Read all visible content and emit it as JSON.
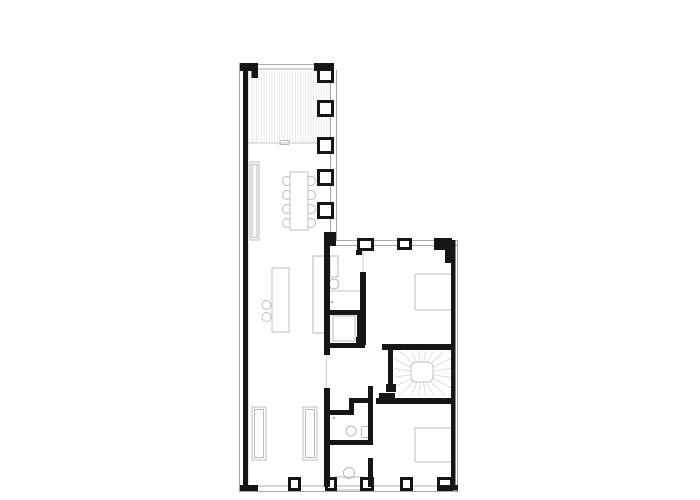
{
  "document": {
    "kind": "architectural-floor-plan",
    "background": "#ffffff",
    "canvas": {
      "width": 700,
      "height": 500
    }
  },
  "palette": {
    "wall_black": "#161616",
    "outer_face_gray": "#8f8f8f",
    "sill_gray": "#c4c4c4",
    "furniture_gray": "#bdbdbd",
    "hatch_gray": "#e1e1e1",
    "tread_gray": "#d7d7d7"
  },
  "shapes": [
    {
      "name": "outer-face-left",
      "type": "line",
      "style": "thin",
      "x1": 239.5,
      "y1": 63,
      "x2": 239.5,
      "y2": 492
    },
    {
      "name": "inner-face-left",
      "type": "line",
      "style": "sill",
      "x1": 248,
      "y1": 70,
      "x2": 248,
      "y2": 485
    },
    {
      "name": "top-window-sill-outer",
      "type": "line",
      "style": "thin",
      "x1": 256,
      "y1": 64.5,
      "x2": 316,
      "y2": 64.5
    },
    {
      "name": "top-window-sill-inner",
      "type": "line",
      "style": "thin",
      "x1": 256,
      "y1": 69,
      "x2": 316,
      "y2": 69
    },
    {
      "name": "east-wall-face-outer",
      "type": "line",
      "style": "thin",
      "x1": 336.5,
      "y1": 70,
      "x2": 336.5,
      "y2": 241
    },
    {
      "name": "east-wall-face-inner",
      "type": "line",
      "style": "thin",
      "x1": 330.5,
      "y1": 70,
      "x2": 330.5,
      "y2": 241
    },
    {
      "name": "wing-top-sill-outer",
      "type": "line",
      "style": "thin",
      "x1": 334,
      "y1": 240.5,
      "x2": 457,
      "y2": 240.5
    },
    {
      "name": "wing-top-sill-inner",
      "type": "line",
      "style": "thin",
      "x1": 334,
      "y1": 245.5,
      "x2": 457,
      "y2": 245.5
    },
    {
      "name": "outer-face-right",
      "type": "line",
      "style": "thin",
      "x1": 457.5,
      "y1": 240,
      "x2": 457.5,
      "y2": 492
    },
    {
      "name": "bottom-sill-outer",
      "type": "line",
      "style": "thin",
      "x1": 240,
      "y1": 491.5,
      "x2": 458,
      "y2": 491.5
    },
    {
      "name": "bottom-sill-inner",
      "type": "line",
      "style": "thin",
      "x1": 240,
      "y1": 486,
      "x2": 458,
      "y2": 486
    },
    {
      "name": "living-door-opening",
      "type": "line",
      "style": "sill",
      "x1": 326.5,
      "y1": 355,
      "x2": 326.5,
      "y2": 388
    },
    {
      "name": "ensuite-door-opening",
      "type": "line",
      "style": "sill",
      "x1": 363,
      "y1": 252,
      "x2": 363,
      "y2": 272
    },
    {
      "name": "deck-hatch",
      "type": "hatch",
      "style": "hatchln",
      "x": 248.5,
      "y": 71,
      "w": 81,
      "h": 71,
      "step": 2.6
    },
    {
      "name": "deck-edge",
      "type": "line",
      "style": "sill",
      "x1": 248,
      "y1": 143,
      "x2": 330,
      "y2": 143
    },
    {
      "name": "deck-threshold",
      "type": "rect",
      "style": "fixture",
      "x": 280,
      "y": 140.5,
      "w": 9,
      "h": 4
    },
    {
      "name": "sideboard",
      "type": "rect",
      "style": "furn",
      "x": 250,
      "y": 162,
      "w": 9,
      "h": 78
    },
    {
      "name": "sideboard-inner",
      "type": "rect",
      "style": "fixture",
      "x": 252,
      "y": 164.5,
      "w": 5,
      "h": 73
    },
    {
      "name": "dining-chair",
      "type": "circle",
      "style": "furn",
      "cx": 287,
      "cy": 181,
      "r": 4.5
    },
    {
      "name": "dining-chair",
      "type": "circle",
      "style": "furn",
      "cx": 287,
      "cy": 195,
      "r": 4.5
    },
    {
      "name": "dining-chair",
      "type": "circle",
      "style": "furn",
      "cx": 287,
      "cy": 209,
      "r": 4.5
    },
    {
      "name": "dining-chair",
      "type": "circle",
      "style": "furn",
      "cx": 287,
      "cy": 223,
      "r": 4.5
    },
    {
      "name": "dining-chair",
      "type": "circle",
      "style": "furn",
      "cx": 311,
      "cy": 181,
      "r": 4.5
    },
    {
      "name": "dining-chair",
      "type": "circle",
      "style": "furn",
      "cx": 311,
      "cy": 195,
      "r": 4.5
    },
    {
      "name": "dining-chair",
      "type": "circle",
      "style": "furn",
      "cx": 311,
      "cy": 209,
      "r": 4.5
    },
    {
      "name": "dining-chair",
      "type": "circle",
      "style": "furn",
      "cx": 311,
      "cy": 223,
      "r": 4.5
    },
    {
      "name": "dining-table",
      "type": "rect",
      "style": "furn",
      "x": 290,
      "y": 172,
      "w": 18,
      "h": 58
    },
    {
      "name": "bar-stool",
      "type": "circle",
      "style": "furn",
      "cx": 266.5,
      "cy": 305,
      "r": 4.5
    },
    {
      "name": "bar-stool",
      "type": "circle",
      "style": "furn",
      "cx": 266.5,
      "cy": 317,
      "r": 4.5
    },
    {
      "name": "kitchen-island",
      "type": "rect",
      "style": "furn",
      "x": 272,
      "y": 268,
      "w": 17,
      "h": 64
    },
    {
      "name": "kitchen-counter",
      "type": "rect",
      "style": "fixture",
      "x": 313,
      "y": 256,
      "w": 13,
      "h": 77
    },
    {
      "name": "wardrobe",
      "type": "rect",
      "style": "furn",
      "x": 252,
      "y": 407,
      "w": 14,
      "h": 53
    },
    {
      "name": "wardrobe-inner",
      "type": "rect",
      "style": "fixture",
      "x": 254.5,
      "y": 409.5,
      "w": 9,
      "h": 48
    },
    {
      "name": "wardrobe",
      "type": "rect",
      "style": "furn",
      "x": 303,
      "y": 407,
      "w": 14,
      "h": 53
    },
    {
      "name": "wardrobe-inner",
      "type": "rect",
      "style": "fixture",
      "x": 305.5,
      "y": 409.5,
      "w": 9,
      "h": 48
    },
    {
      "name": "bed-upper-bedroom",
      "type": "rect",
      "style": "furn",
      "x": 415,
      "y": 274,
      "w": 37,
      "h": 36
    },
    {
      "name": "bed-lower-bedroom",
      "type": "rect",
      "style": "furn",
      "x": 415,
      "y": 428,
      "w": 37,
      "h": 34
    },
    {
      "name": "ensuite-cabinet",
      "type": "rect",
      "style": "fixture",
      "x": 330,
      "y": 256,
      "w": 8,
      "h": 21
    },
    {
      "name": "ensuite-sink",
      "type": "circle",
      "style": "fixture",
      "cx": 334,
      "cy": 284,
      "r": 5
    },
    {
      "name": "ensuite-counter",
      "type": "line",
      "style": "sill",
      "x1": 328,
      "y1": 291,
      "x2": 361,
      "y2": 291
    },
    {
      "name": "ensuite-drain",
      "type": "circle",
      "style": "fixture",
      "cx": 332,
      "cy": 302,
      "r": 0.8
    },
    {
      "name": "closet-liner",
      "type": "rect",
      "style": "fixture",
      "x": 333,
      "y": 316,
      "w": 22,
      "h": 25
    },
    {
      "name": "wc-sink",
      "type": "circle",
      "style": "fixture",
      "cx": 351,
      "cy": 431,
      "r": 5
    },
    {
      "name": "wc-toilet",
      "type": "rect",
      "style": "fixture",
      "x": 361.5,
      "y": 426.5,
      "w": 9,
      "h": 11,
      "rx": 2
    },
    {
      "name": "wc-drain",
      "type": "circle",
      "style": "fixture",
      "cx": 334,
      "cy": 418,
      "r": 0.8
    },
    {
      "name": "bath-sink",
      "type": "circle",
      "style": "fixture",
      "cx": 349,
      "cy": 473,
      "r": 5.5
    },
    {
      "name": "bath-vanity",
      "type": "rect",
      "style": "fixture",
      "x": 334,
      "y": 477,
      "w": 29,
      "h": 13
    },
    {
      "name": "stair-treads",
      "type": "fan",
      "style": "tread",
      "cx": 422,
      "cy": 373,
      "rect": [
        394,
        351,
        57,
        45
      ],
      "count": 20
    },
    {
      "name": "stair-landing",
      "type": "rect",
      "style": "landing",
      "x": 411,
      "y": 362,
      "w": 22,
      "h": 20,
      "rx": 5
    },
    {
      "name": "exterior-wall-left",
      "type": "rect",
      "style": "wall",
      "x": 243,
      "y": 63,
      "w": 5,
      "h": 424
    },
    {
      "name": "corner-pier-top-left",
      "type": "rect",
      "style": "wall",
      "x": 240,
      "y": 63,
      "w": 18,
      "h": 8
    },
    {
      "name": "corner-pier-top-left-return",
      "type": "rect",
      "style": "wall",
      "x": 251.5,
      "y": 70,
      "w": 6.5,
      "h": 8
    },
    {
      "name": "corner-pier-top-right",
      "type": "rect",
      "style": "wall",
      "x": 314,
      "y": 63,
      "w": 20,
      "h": 8
    },
    {
      "name": "window-pier",
      "type": "rect",
      "style": "wall",
      "x": 317,
      "y": 68,
      "w": 17,
      "h": 15
    },
    {
      "name": "window-pier-void",
      "type": "rect",
      "style": "white",
      "x": 320,
      "y": 71,
      "w": 11,
      "h": 9
    },
    {
      "name": "window-pier",
      "type": "rect",
      "style": "wall",
      "x": 317,
      "y": 100,
      "w": 17,
      "h": 17
    },
    {
      "name": "window-pier-void",
      "type": "rect",
      "style": "white",
      "x": 320,
      "y": 103,
      "w": 11,
      "h": 11
    },
    {
      "name": "window-pier",
      "type": "rect",
      "style": "wall",
      "x": 317,
      "y": 137,
      "w": 17,
      "h": 17
    },
    {
      "name": "window-pier-void",
      "type": "rect",
      "style": "white",
      "x": 320,
      "y": 140,
      "w": 11,
      "h": 11
    },
    {
      "name": "window-pier",
      "type": "rect",
      "style": "wall",
      "x": 317,
      "y": 169,
      "w": 17,
      "h": 17
    },
    {
      "name": "window-pier-void",
      "type": "rect",
      "style": "white",
      "x": 320,
      "y": 172,
      "w": 11,
      "h": 11
    },
    {
      "name": "window-pier",
      "type": "rect",
      "style": "wall",
      "x": 317,
      "y": 202,
      "w": 17,
      "h": 17
    },
    {
      "name": "window-pier-void",
      "type": "rect",
      "style": "white",
      "x": 320,
      "y": 205,
      "w": 11,
      "h": 11
    },
    {
      "name": "wall-corner-jog",
      "type": "rect",
      "style": "wall",
      "x": 324,
      "y": 232,
      "w": 12,
      "h": 14
    },
    {
      "name": "window-pier",
      "type": "rect",
      "style": "wall",
      "x": 357,
      "y": 238,
      "w": 17,
      "h": 13
    },
    {
      "name": "window-pier-void",
      "type": "rect",
      "style": "white",
      "x": 360,
      "y": 241,
      "w": 11,
      "h": 7
    },
    {
      "name": "pier-foot",
      "type": "rect",
      "style": "wall",
      "x": 356,
      "y": 250,
      "w": 6,
      "h": 5
    },
    {
      "name": "window-pier",
      "type": "rect",
      "style": "wall",
      "x": 397,
      "y": 238,
      "w": 15,
      "h": 12
    },
    {
      "name": "window-pier-void",
      "type": "rect",
      "style": "white",
      "x": 400,
      "y": 241,
      "w": 9,
      "h": 6
    },
    {
      "name": "corner-pier-wing",
      "type": "rect",
      "style": "wall",
      "x": 434,
      "y": 238,
      "w": 18,
      "h": 12
    },
    {
      "name": "corner-pier-wing-return",
      "type": "rect",
      "style": "wall",
      "x": 445,
      "y": 247,
      "w": 7,
      "h": 16
    },
    {
      "name": "exterior-wall-right",
      "type": "rect",
      "style": "wall",
      "x": 451,
      "y": 240,
      "w": 4.5,
      "h": 250
    },
    {
      "name": "window-pier",
      "type": "rect",
      "style": "wall",
      "x": 437,
      "y": 477,
      "w": 16,
      "h": 14
    },
    {
      "name": "window-pier-void",
      "type": "rect",
      "style": "white",
      "x": 440,
      "y": 480,
      "w": 10,
      "h": 8
    },
    {
      "name": "bottom-wall-corner-right",
      "type": "rect",
      "style": "wall",
      "x": 437,
      "y": 485,
      "w": 21,
      "h": 5.5
    },
    {
      "name": "bottom-wall-corner-left",
      "type": "rect",
      "style": "wall",
      "x": 240,
      "y": 485,
      "w": 18,
      "h": 6
    },
    {
      "name": "window-pier",
      "type": "rect",
      "style": "wall",
      "x": 288,
      "y": 477,
      "w": 13,
      "h": 14
    },
    {
      "name": "window-pier-void",
      "type": "rect",
      "style": "white",
      "x": 291,
      "y": 480,
      "w": 7,
      "h": 8
    },
    {
      "name": "window-pier",
      "type": "rect",
      "style": "wall",
      "x": 325,
      "y": 477,
      "w": 12,
      "h": 14
    },
    {
      "name": "window-pier-void",
      "type": "rect",
      "style": "white",
      "x": 328,
      "y": 480,
      "w": 6,
      "h": 8
    },
    {
      "name": "window-pier",
      "type": "rect",
      "style": "wall",
      "x": 360,
      "y": 477,
      "w": 14,
      "h": 14
    },
    {
      "name": "window-pier-void",
      "type": "rect",
      "style": "white",
      "x": 363,
      "y": 480,
      "w": 8,
      "h": 8
    },
    {
      "name": "window-pier",
      "type": "rect",
      "style": "wall",
      "x": 400,
      "y": 477,
      "w": 13,
      "h": 14
    },
    {
      "name": "window-pier-void",
      "type": "rect",
      "style": "white",
      "x": 403,
      "y": 480,
      "w": 7,
      "h": 8
    },
    {
      "name": "interior-wall-main-upper",
      "type": "rect",
      "style": "wall",
      "x": 324,
      "y": 243,
      "w": 6,
      "h": 112
    },
    {
      "name": "interior-wall-main-lower",
      "type": "rect",
      "style": "wall",
      "x": 324,
      "y": 388,
      "w": 6,
      "h": 99
    },
    {
      "name": "ensuite-bedroom-wall",
      "type": "rect",
      "style": "wall",
      "x": 360,
      "y": 272,
      "w": 6,
      "h": 73
    },
    {
      "name": "ensuite-wall-foot",
      "type": "rect",
      "style": "wall",
      "x": 356,
      "y": 337,
      "w": 10,
      "h": 8
    },
    {
      "name": "ensuite-closet-wall",
      "type": "rect",
      "style": "wall",
      "x": 330,
      "y": 310,
      "w": 32,
      "h": 5
    },
    {
      "name": "closet-right-wall",
      "type": "rect",
      "style": "wall",
      "x": 357,
      "y": 310,
      "w": 5,
      "h": 38
    },
    {
      "name": "closet-bottom-wall",
      "type": "rect",
      "style": "wall",
      "x": 328,
      "y": 343,
      "w": 37,
      "h": 5
    },
    {
      "name": "stair-top-wall",
      "type": "rect",
      "style": "wall",
      "x": 382,
      "y": 344,
      "w": 73,
      "h": 6
    },
    {
      "name": "stair-left-wall",
      "type": "rect",
      "style": "wall",
      "x": 388,
      "y": 350,
      "w": 5,
      "h": 36
    },
    {
      "name": "stair-newel-upper",
      "type": "rect",
      "style": "wall",
      "x": 386,
      "y": 384,
      "w": 10,
      "h": 8
    },
    {
      "name": "stair-bottom-wall",
      "type": "rect",
      "style": "wall",
      "x": 376,
      "y": 398,
      "w": 79,
      "h": 6
    },
    {
      "name": "stair-newel-lower",
      "type": "rect",
      "style": "wall",
      "x": 379,
      "y": 393,
      "w": 16,
      "h": 11
    },
    {
      "name": "hall-connector-wall",
      "type": "rect",
      "style": "wall",
      "x": 368,
      "y": 386,
      "w": 5,
      "h": 18
    },
    {
      "name": "wc-top-wall",
      "type": "rect",
      "style": "wall",
      "x": 328,
      "y": 410,
      "w": 25,
      "h": 5
    },
    {
      "name": "wc-jog-vertical",
      "type": "rect",
      "style": "wall",
      "x": 349,
      "y": 398,
      "w": 5,
      "h": 17
    },
    {
      "name": "wc-jog-horizontal",
      "type": "rect",
      "style": "wall",
      "x": 349,
      "y": 398,
      "w": 22,
      "h": 5
    },
    {
      "name": "wc-right-wall",
      "type": "rect",
      "style": "wall",
      "x": 368,
      "y": 398,
      "w": 5,
      "h": 42
    },
    {
      "name": "wc-bottom-wall",
      "type": "rect",
      "style": "wall",
      "x": 328,
      "y": 440,
      "w": 45,
      "h": 5
    },
    {
      "name": "bedroom-lower-left-wall",
      "type": "rect",
      "style": "wall",
      "x": 368,
      "y": 458,
      "w": 5,
      "h": 29
    }
  ]
}
